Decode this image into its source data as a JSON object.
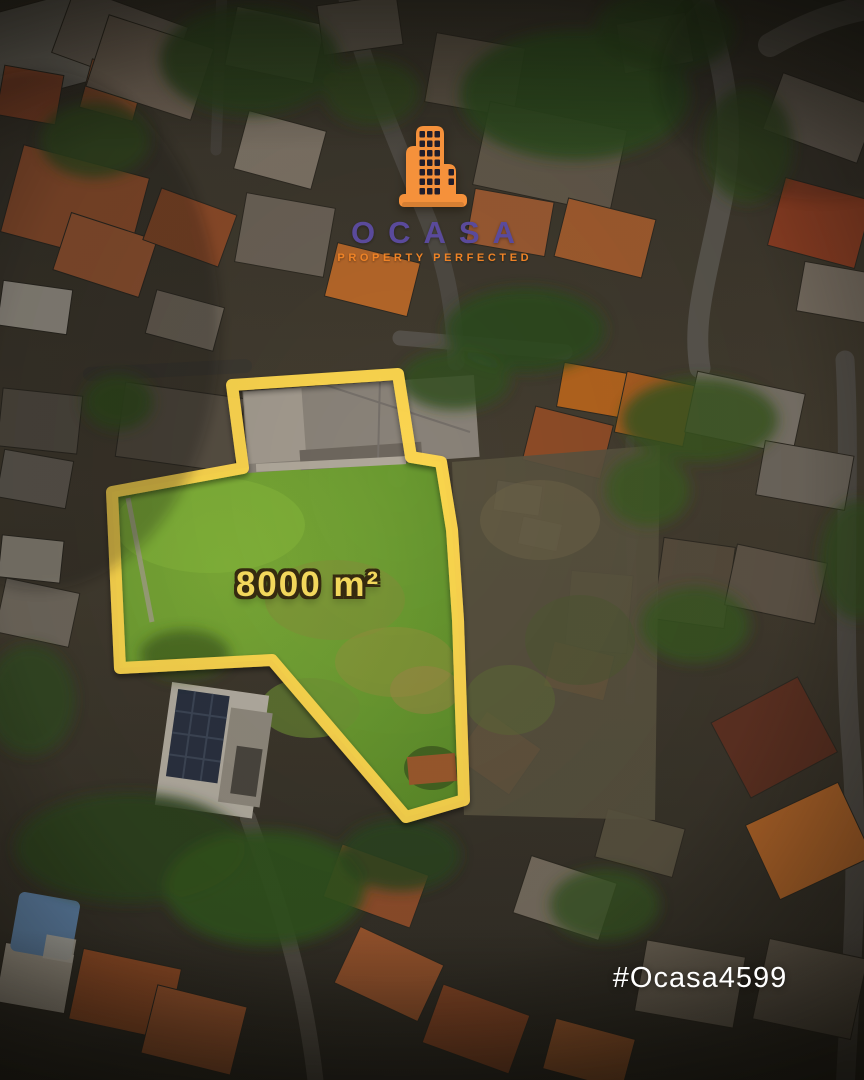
{
  "brand": {
    "name": "OCASA",
    "tagline": "PROPERTY PERFECTED"
  },
  "brand_colors": {
    "building_orange": "#F5913B",
    "name_purple": "#5A4A9B",
    "tagline_orange": "#EF8326"
  },
  "plot": {
    "area_label": "8000 m²",
    "outline_color": "#FFD84F",
    "grass_color": "#6F9E33",
    "area_text_color": "#F2D75C"
  },
  "footer": {
    "hashtag": "#Ocasa4599",
    "text_color": "#FFFFFF"
  }
}
